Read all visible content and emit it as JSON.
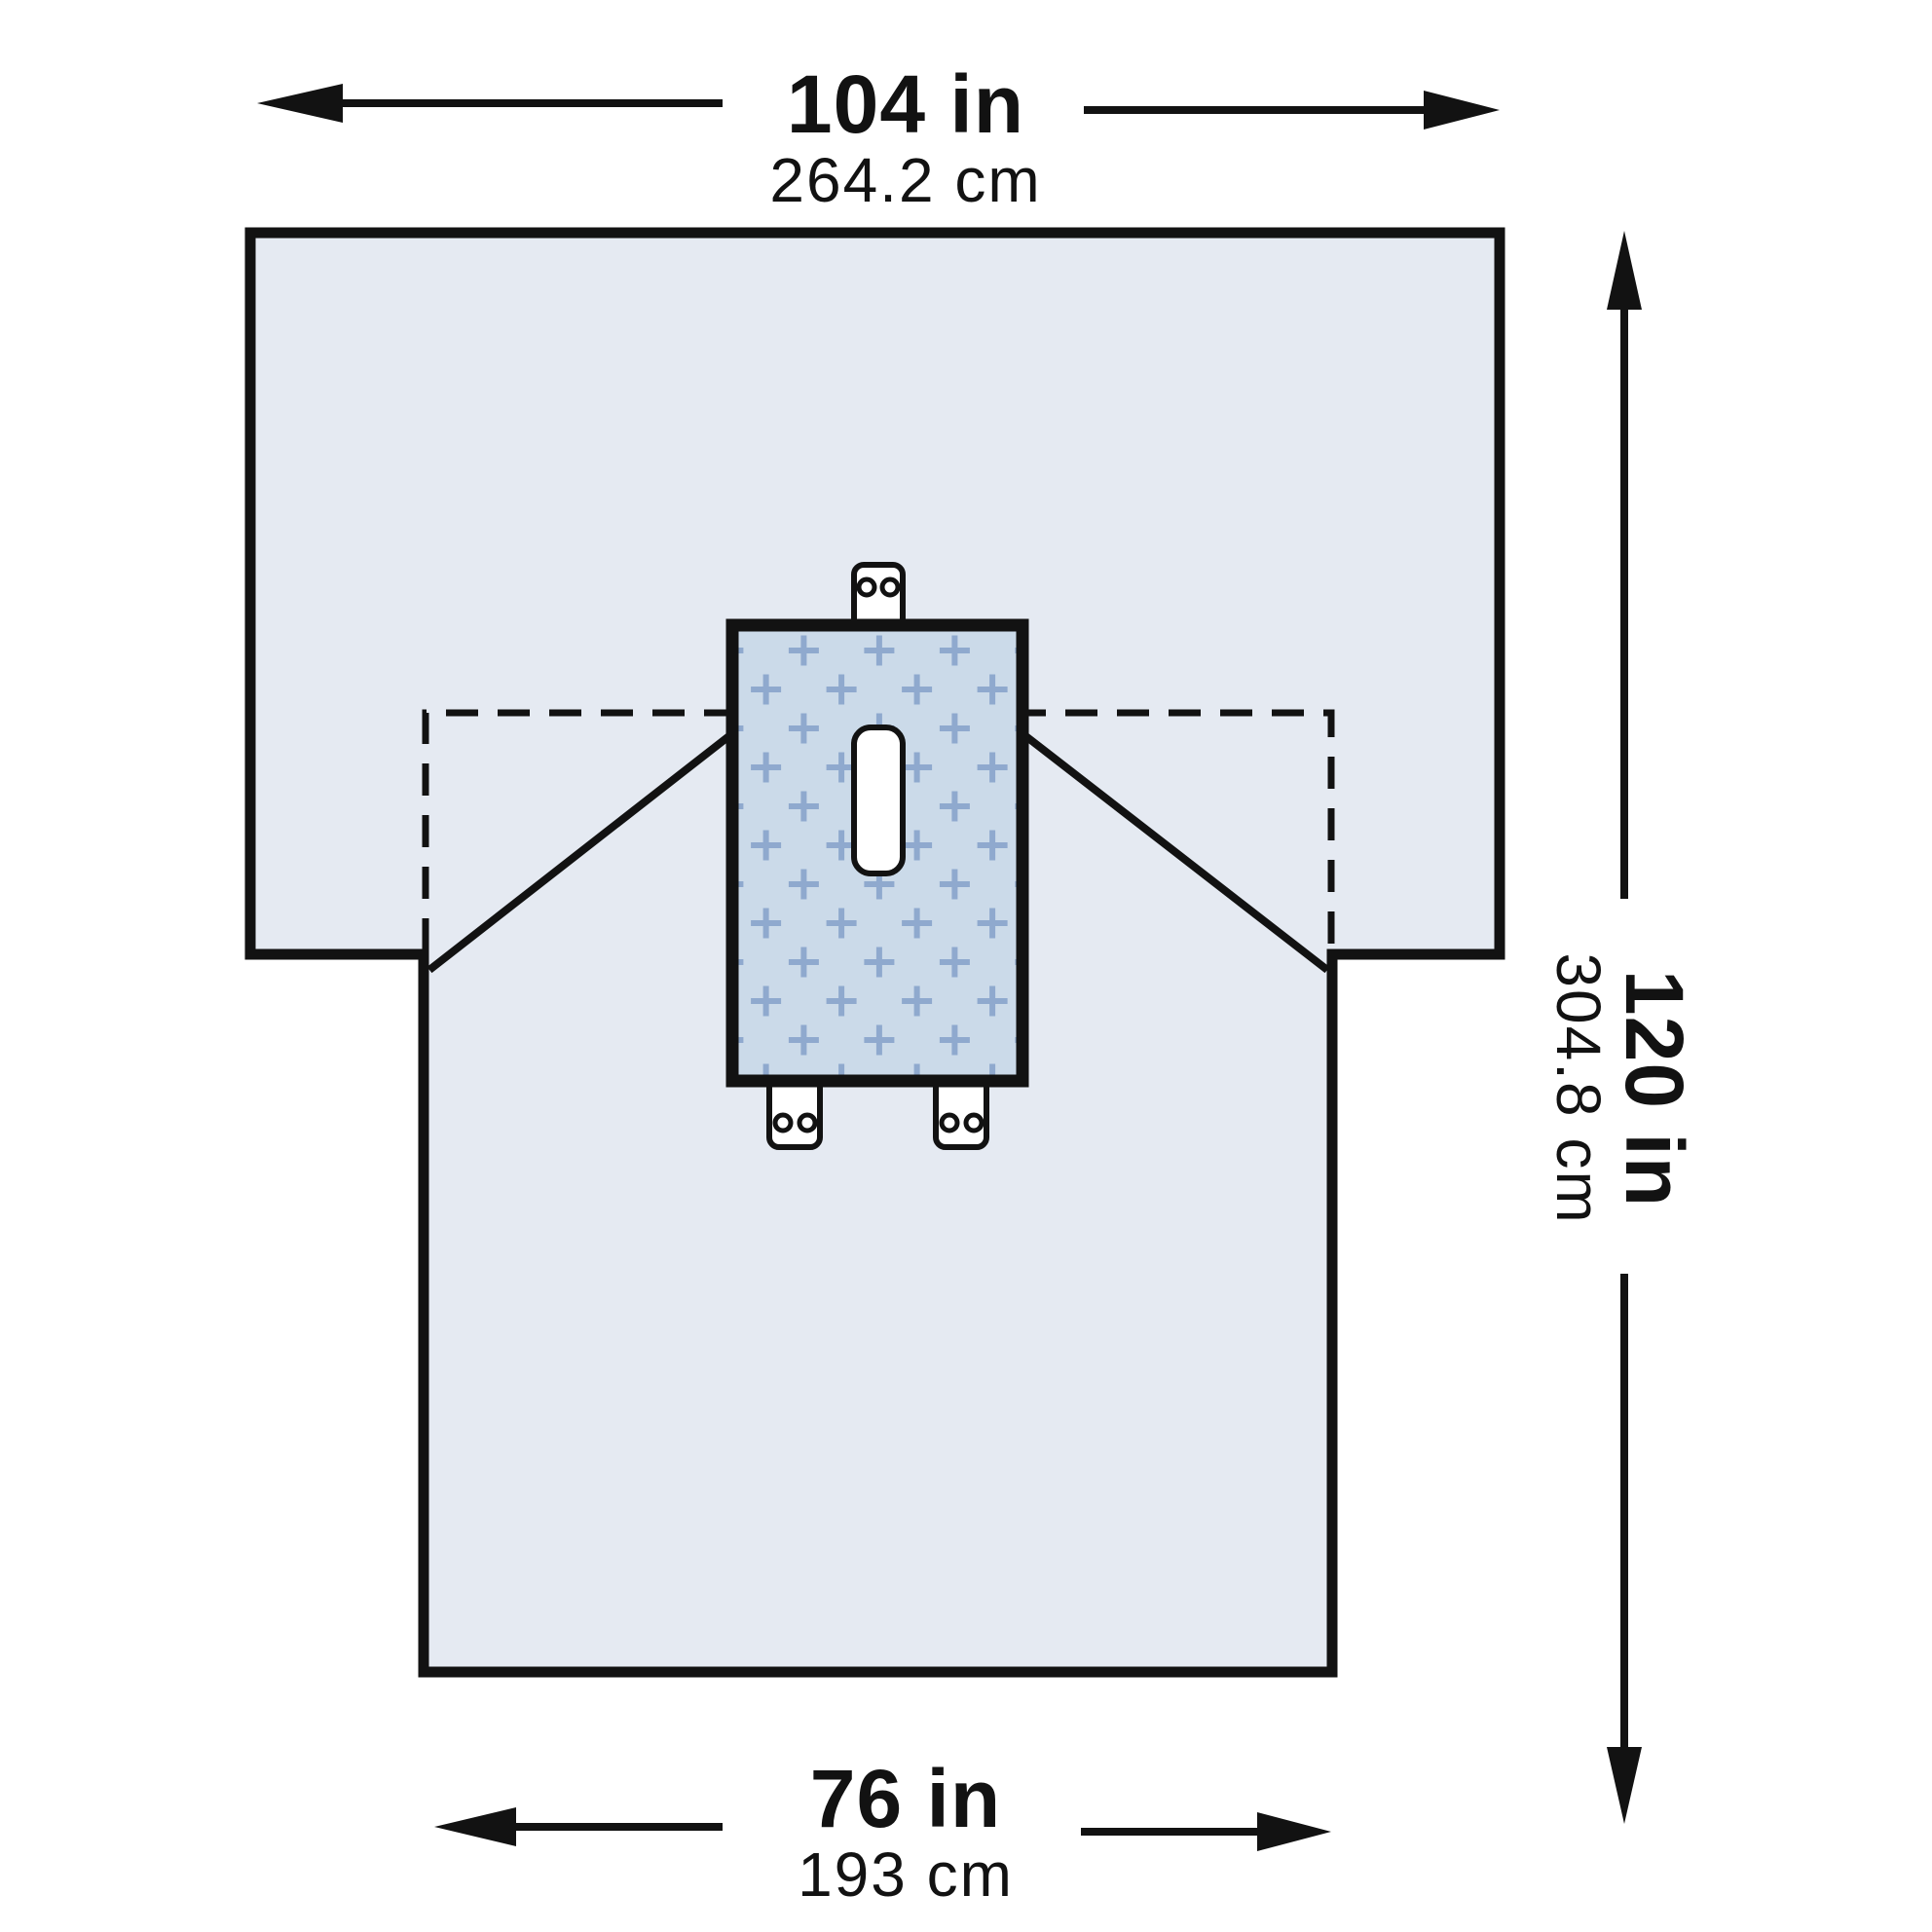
{
  "labels": {
    "top_width": {
      "value_in": "104 in",
      "value_cm": "264.2 cm"
    },
    "right_height": {
      "value_in": "120 in",
      "value_cm": "304.8 cm"
    },
    "bottom_width": {
      "value_in": "76 in",
      "value_cm": "193 cm"
    }
  },
  "measurements": {
    "top_width_in": 104,
    "top_width_cm": 264.2,
    "height_in": 120,
    "height_cm": 304.8,
    "bottom_width_in": 76,
    "bottom_width_cm": 193
  },
  "colors": {
    "background": "#ffffff",
    "line": "#121212",
    "drape_fill": "#e5eaf2",
    "reinforcement_fill": "#cbdae9",
    "plus_mark": "#8fa9ce",
    "tab_fill": "#ffffff",
    "fenestration_fill": "#ffffff"
  },
  "diagram": {
    "fenestration_count": 1,
    "adhesive_tab_count": 3
  }
}
